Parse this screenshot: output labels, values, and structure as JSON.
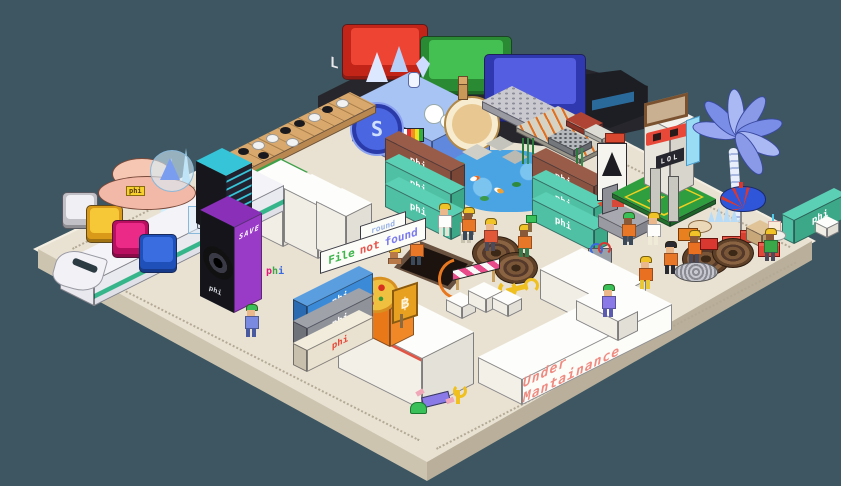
{
  "scene": {
    "title": "isometric pixel-art construction playground",
    "background": "#3d5661"
  },
  "palette": {
    "bg": "#3d5661",
    "plat-top": "#e9e2d3",
    "plat-rim": "#f3eee1",
    "plat-left": "#cdc4b0",
    "plat-right": "#b9af9a",
    "plat-dots": "#b3a995",
    "teal-container": "#4fc0a4",
    "brown-container": "#8a5240",
    "blue-container": "#3a8ad8",
    "grey-container": "#90929a",
    "cream-container": "#eae2d0",
    "orange-container": "#e87818",
    "white-box": "#f6f4ee",
    "pond-blue": "#4aa4e4",
    "court-green": "#2f9e3f",
    "vest-orange": "#e87828",
    "hat-yellow": "#f0c428",
    "hat-green": "#3ac058"
  },
  "signs": {
    "file_not_found": {
      "words": [
        {
          "text": "File",
          "color": "#3cb54a"
        },
        {
          "text": "not",
          "color": "#e8554d"
        },
        {
          "text": "found",
          "color": "#7b7bf0"
        }
      ]
    },
    "under_maintenance": {
      "text": "Under Mantainance",
      "color": "#f08a80"
    },
    "round_sign": {
      "text": "round",
      "color": "#9ab4e8"
    },
    "save_label": {
      "text": "SAVE",
      "color": "#ffffff"
    },
    "speaker_brand": {
      "text": "phi",
      "color": "#ffffff"
    },
    "lol_label": {
      "text": "LOL",
      "color": "#f0f0f0"
    },
    "truck_label": {
      "text": "LAN",
      "color": "#e8e8ec"
    },
    "court_brand": {
      "text": "phi",
      "color": "#f5d02e"
    },
    "saucer_badge": {
      "text": "phi",
      "color": "#5a3a10"
    },
    "bitcoin_symbol": "฿",
    "coin_symbol": "S",
    "phi_blocks": {
      "letters": [
        "p",
        "h",
        "i"
      ],
      "colors": [
        "#e0187c",
        "#3aa848",
        "#3a6ae0"
      ]
    }
  },
  "containers": {
    "logo": "phi",
    "stacks": [
      {
        "position": "left",
        "units": [
          "blue",
          "grey",
          "cream"
        ]
      },
      {
        "position": "center",
        "units": [
          "brown",
          "teal",
          "teal"
        ]
      },
      {
        "position": "right",
        "units": [
          "brown",
          "teal",
          "teal"
        ]
      },
      {
        "position": "far-right",
        "units": [
          "teal"
        ]
      }
    ]
  },
  "keycaps": {
    "train_keys": [
      "white",
      "yellow",
      "magenta",
      "blue"
    ],
    "truck_keys": [
      "red",
      "green",
      "blue"
    ]
  },
  "workers": {
    "count": 16,
    "hard_hat_colors": [
      "#f0c428",
      "#3ac058"
    ],
    "vest_color": "#e87828",
    "activities": [
      "digging pit",
      "taking selfie",
      "carrying axe",
      "drinking",
      "lying down",
      "building wall"
    ]
  },
  "props": [
    "bullet-train",
    "flying-saucer",
    "speaker-towers",
    "go-board",
    "keycap-truck",
    "locomotive",
    "coin-wheel",
    "cheese-drum",
    "meerkat",
    "keyboard",
    "circuit-board",
    "calculator",
    "koi-pond",
    "stepping-stones",
    "reeds",
    "shipping-containers",
    "pizza-container",
    "bitcoin-sign",
    "construction-pit",
    "cable-spools",
    "barricade",
    "wrench",
    "banner-flag",
    "throne",
    "watchtower",
    "tennis-court",
    "palm-tree",
    "beach-umbrella",
    "picnic-tables",
    "white-buildings",
    "husky-case",
    "slime"
  ]
}
